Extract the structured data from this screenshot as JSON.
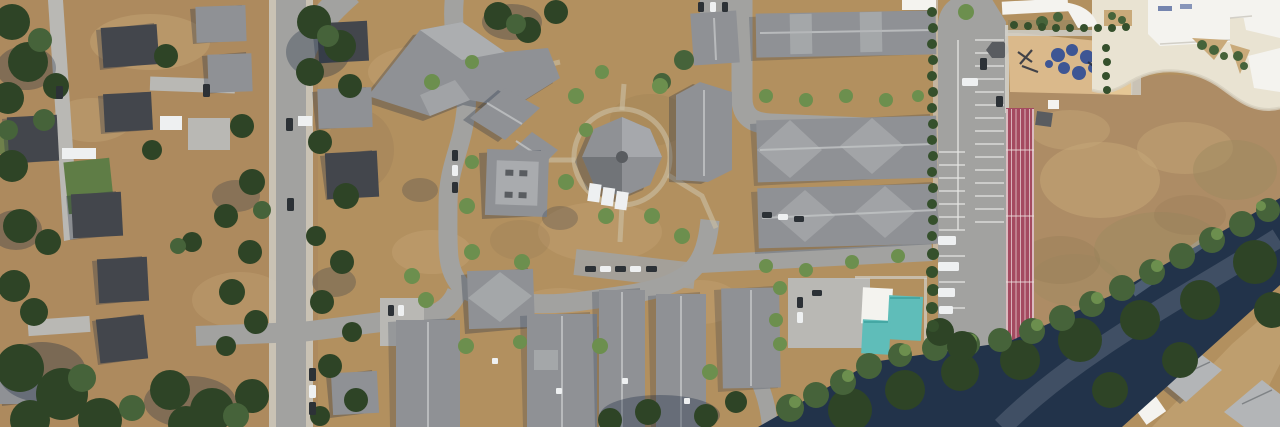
{
  "scene": {
    "type": "aerial-photograph",
    "description": "Daytime satellite/aerial view of a suburban neighborhood: detached houses among tall trees on the west, a large townhouse condominium complex with gray gabled roofs and an octagonal clubhouse in the center, a school campus with cream plaza, sand playground with blue play mounds, striped parking lot, straight red running track and large dry dirt field on the east, and a diagonal tree-shaded road crossing the bottom-right corner.",
    "width_px": 1280,
    "height_px": 427
  },
  "palette": {
    "base_tan": "#b2905f",
    "west_tan": "#ab8a5e",
    "dirt_light": "#c9aa7a",
    "dirt_dark": "#8d7250",
    "field_brown": "#ad8c65",
    "field_olive": "#9d8960",
    "grass_green": "#5f7d46",
    "road": "#a2a2a0",
    "road_light": "#b9b8b4",
    "sidewalk": "#d0cfc9",
    "plaza": "#e9e3d2",
    "white": "#f4f3ef",
    "roof_mid": "#8f9195",
    "roof_light": "#b3b5b7",
    "roof_pale": "#a9abae",
    "roof_dark": "#595c60",
    "roof_slate": "#43464c",
    "band_navy": "#22334a",
    "tree_dark": "#2e4426",
    "tree_mid": "#46633a",
    "tree_bright": "#6c8f4e",
    "hedge": "#35502c",
    "track_red": "#a44a60",
    "play_sand": "#dab98b",
    "play_sand_light": "#e5c795",
    "play_blue": "#3e5694",
    "teal": "#5fbdb9",
    "car_dark": "#2c3136",
    "car_white": "#eef0f1",
    "shadow_navy": "#1d2b42"
  },
  "features": [
    {
      "name": "residential-street-west",
      "description": "North-south residential street with sidewalks, parked cars and detached houses under large conifers"
    },
    {
      "name": "narrow-lane-west",
      "description": "Narrow private lane running down the far west side"
    },
    {
      "name": "townhouse-complex",
      "description": "Condominium complex of gray-roofed townhouse rows around looping internal drives on dry tan lawns"
    },
    {
      "name": "octagonal-clubhouse",
      "description": "Octagonal-roofed clubhouse ringed by a walking path at the center of the complex"
    },
    {
      "name": "community-pool",
      "description": "Recreation building with two teal roofs beside a small parking pad"
    },
    {
      "name": "school-campus",
      "description": "School with bright white roofs and a curved cream concrete plaza, top right"
    },
    {
      "name": "playground",
      "description": "Sand play area with dark-blue rubber mounds and play structures"
    },
    {
      "name": "parking-lot",
      "description": "Surface parking lot with white stall striping, RVs and a dark shade canopy"
    },
    {
      "name": "running-track",
      "description": "Straight red sprint lanes with white lines along the field's west edge"
    },
    {
      "name": "dirt-field",
      "description": "Large dry brown playing field"
    },
    {
      "name": "tree-lined-road",
      "description": "Diagonal road buried in deep tree shadow crossing the bottom-right corner"
    }
  ]
}
